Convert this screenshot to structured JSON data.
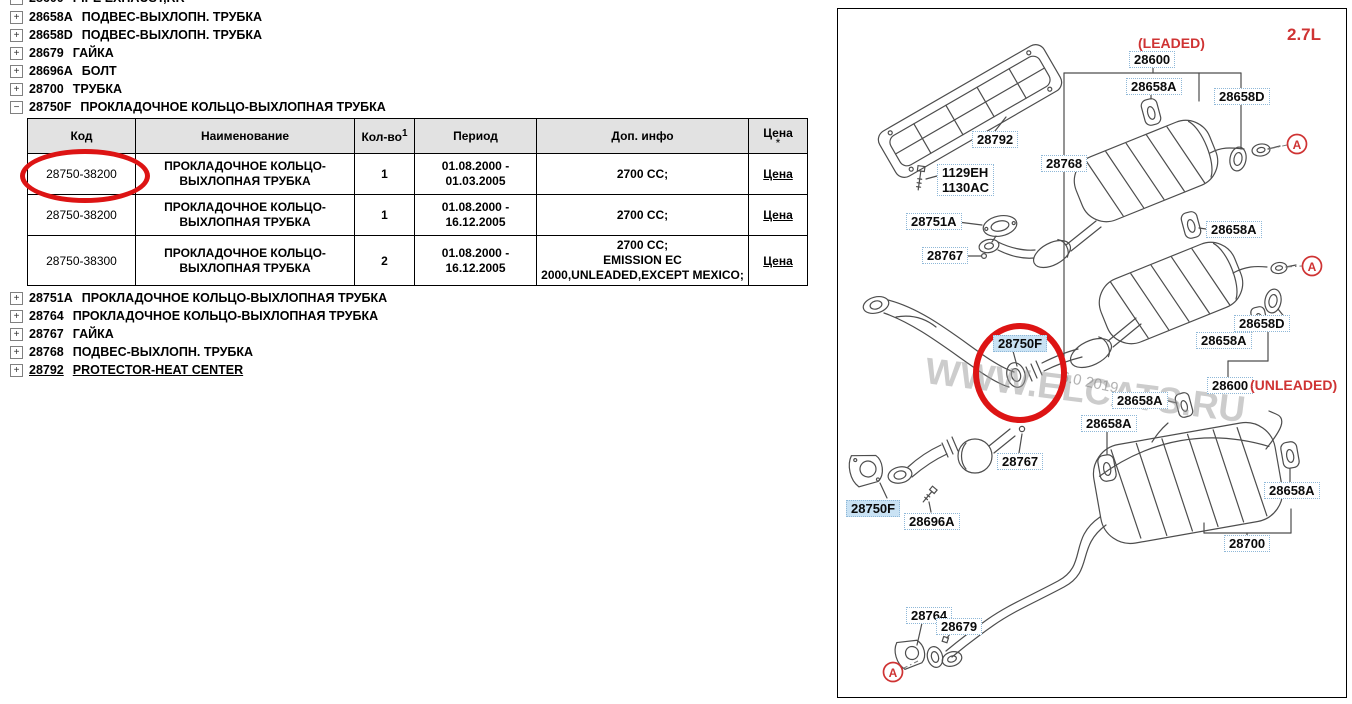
{
  "tree": {
    "top_items": [
      {
        "icon": "+",
        "code": "28600",
        "name": "PIPE EXHAUST,RR"
      },
      {
        "icon": "+",
        "code": "28658A",
        "name": "ПОДВЕС-ВЫХЛОПН. ТРУБКА"
      },
      {
        "icon": "+",
        "code": "28658D",
        "name": "ПОДВЕС-ВЫХЛОПН. ТРУБКА"
      },
      {
        "icon": "+",
        "code": "28679",
        "name": "ГАЙКА"
      },
      {
        "icon": "+",
        "code": "28696A",
        "name": "БОЛТ"
      },
      {
        "icon": "+",
        "code": "28700",
        "name": "ТРУБКА"
      },
      {
        "icon": "−",
        "code": "28750F",
        "name": "ПРОКЛАДОЧНОЕ КОЛЬЦО-ВЫХЛОПНАЯ ТРУБКА"
      }
    ],
    "bottom_items": [
      {
        "icon": "+",
        "code": "28751A",
        "name": "ПРОКЛАДОЧНОЕ КОЛЬЦО-ВЫХЛОПНАЯ ТРУБКА"
      },
      {
        "icon": "+",
        "code": "28764",
        "name": "ПРОКЛАДОЧНОЕ КОЛЬЦО-ВЫХЛОПНАЯ ТРУБКА"
      },
      {
        "icon": "+",
        "code": "28767",
        "name": "ГАЙКА"
      },
      {
        "icon": "+",
        "code": "28768",
        "name": "ПОДВЕС-ВЫХЛОПН. ТРУБКА"
      },
      {
        "icon": "+",
        "code": "28792",
        "name": "PROTECTOR-HEAT CENTER"
      }
    ]
  },
  "table": {
    "headers": {
      "code": "Код",
      "name": "Наименование",
      "qty": "Кол-во",
      "qty_sup": "1",
      "period": "Период",
      "info": "Доп. инфо",
      "price": "Цена",
      "price_note": "*"
    },
    "rows": [
      {
        "code": "28750-38200",
        "name_lines": [
          "ПРОКЛАДОЧНОЕ КОЛЬЦО-",
          "ВЫХЛОПНАЯ ТРУБКА"
        ],
        "qty": "1",
        "period_lines": [
          "01.08.2000 -",
          "01.03.2005"
        ],
        "info_lines": [
          "2700 CC;"
        ],
        "price": "Цена"
      },
      {
        "code": "28750-38200",
        "name_lines": [
          "ПРОКЛАДОЧНОЕ КОЛЬЦО-",
          "ВЫХЛОПНАЯ ТРУБКА"
        ],
        "qty": "1",
        "period_lines": [
          "01.08.2000 -",
          "16.12.2005"
        ],
        "info_lines": [
          "2700 CC;"
        ],
        "price": "Цена"
      },
      {
        "code": "28750-38300",
        "name_lines": [
          "ПРОКЛАДОЧНОЕ КОЛЬЦО-",
          "ВЫХЛОПНАЯ ТРУБКА"
        ],
        "qty": "2",
        "period_lines": [
          "01.08.2000 -",
          "16.12.2005"
        ],
        "info_lines": [
          "2700 CC;",
          "EMISSION EC",
          "2000,UNLEADED,EXCEPT MEXICO;"
        ],
        "price": "Цена"
      }
    ]
  },
  "diagram": {
    "watermark": "WWW.ELCATS.RU",
    "watermark_date": "6.0 2019",
    "view_marker": "A",
    "labels": [
      {
        "text": "(LEADED)",
        "kind": "red"
      },
      {
        "text": "2.7L",
        "kind": "red-big"
      },
      {
        "text": "28600",
        "kind": "box"
      },
      {
        "text": "28658A",
        "kind": "box"
      },
      {
        "text": "28658D",
        "kind": "box"
      },
      {
        "text": "28792",
        "kind": "box"
      },
      {
        "text": "1129EH",
        "text2": "1130AC",
        "kind": "box"
      },
      {
        "text": "28768",
        "kind": "box"
      },
      {
        "text": "28751A",
        "kind": "box"
      },
      {
        "text": "28658A",
        "kind": "box"
      },
      {
        "text": "28767",
        "kind": "box"
      },
      {
        "text": "28750F",
        "kind": "highlight"
      },
      {
        "text": "28658D",
        "kind": "box"
      },
      {
        "text": "28658A",
        "kind": "box"
      },
      {
        "text": "28600",
        "kind": "box"
      },
      {
        "text": "(UNLEADED)",
        "kind": "red"
      },
      {
        "text": "28658A",
        "kind": "box"
      },
      {
        "text": "28658A",
        "kind": "box"
      },
      {
        "text": "28767",
        "kind": "box"
      },
      {
        "text": "28750F",
        "kind": "highlight"
      },
      {
        "text": "28696A",
        "kind": "box"
      },
      {
        "text": "28658A",
        "kind": "box"
      },
      {
        "text": "28700",
        "kind": "box"
      },
      {
        "text": "28764",
        "kind": "box"
      },
      {
        "text": "28679",
        "kind": "box"
      }
    ]
  },
  "colors": {
    "accent_red": "#dd1414",
    "red_text": "#cf3333",
    "label_border": "#8fb8d8",
    "label_highlight_bg": "#c9e2f4",
    "table_header_bg": "#e2e2e2",
    "watermark_gray": "#9b9b9b"
  }
}
